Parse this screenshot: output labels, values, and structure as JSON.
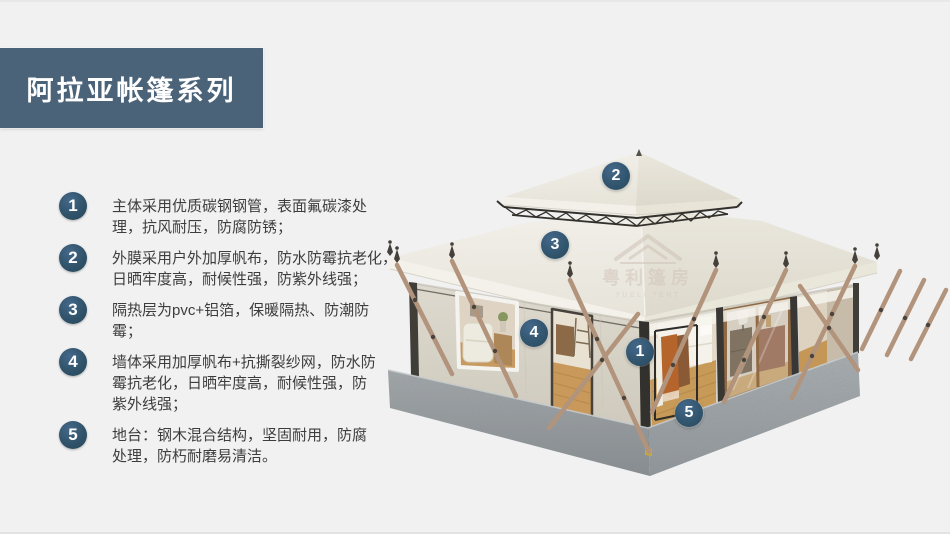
{
  "title": {
    "text": "阿拉亚帐篷系列"
  },
  "features": [
    {
      "num": "1",
      "text": "主体采用优质碳钢钢管，表面氟碳漆处\n理，抗风耐压，防腐防锈；"
    },
    {
      "num": "2",
      "text": "外膜采用户外加厚帆布，防水防霉抗老化，\n日晒牢度高，耐候性强，防紫外线强；"
    },
    {
      "num": "3",
      "text": "隔热层为pvc+铝箔，保暖隔热、防潮防\n霉；"
    },
    {
      "num": "4",
      "text": "墙体采用加厚帆布+抗撕裂纱网，防水防\n霉抗老化，日晒牢度高，耐候性强，防\n紫外线强；"
    },
    {
      "num": "5",
      "text": "地台：钢木混合结构，坚固耐用，防腐\n处理，防朽耐磨易清洁。"
    }
  ],
  "callouts": [
    {
      "label": "1"
    },
    {
      "label": "2"
    },
    {
      "label": "3"
    },
    {
      "label": "4"
    },
    {
      "label": "5"
    }
  ],
  "watermark": {
    "cn": "粤利篷房",
    "en": "YUELI TENT"
  },
  "colors": {
    "background": "#f1f1f2",
    "banner": "#4b6378",
    "badge": "#2f5268",
    "canvas_roof": "#ece9e0",
    "canvas_wall": "#d9d5ca",
    "concrete": "#979da0",
    "wood_pole": "#b2937b",
    "wood_floor": "#c79a58",
    "garment_orange": "#b5642c"
  }
}
